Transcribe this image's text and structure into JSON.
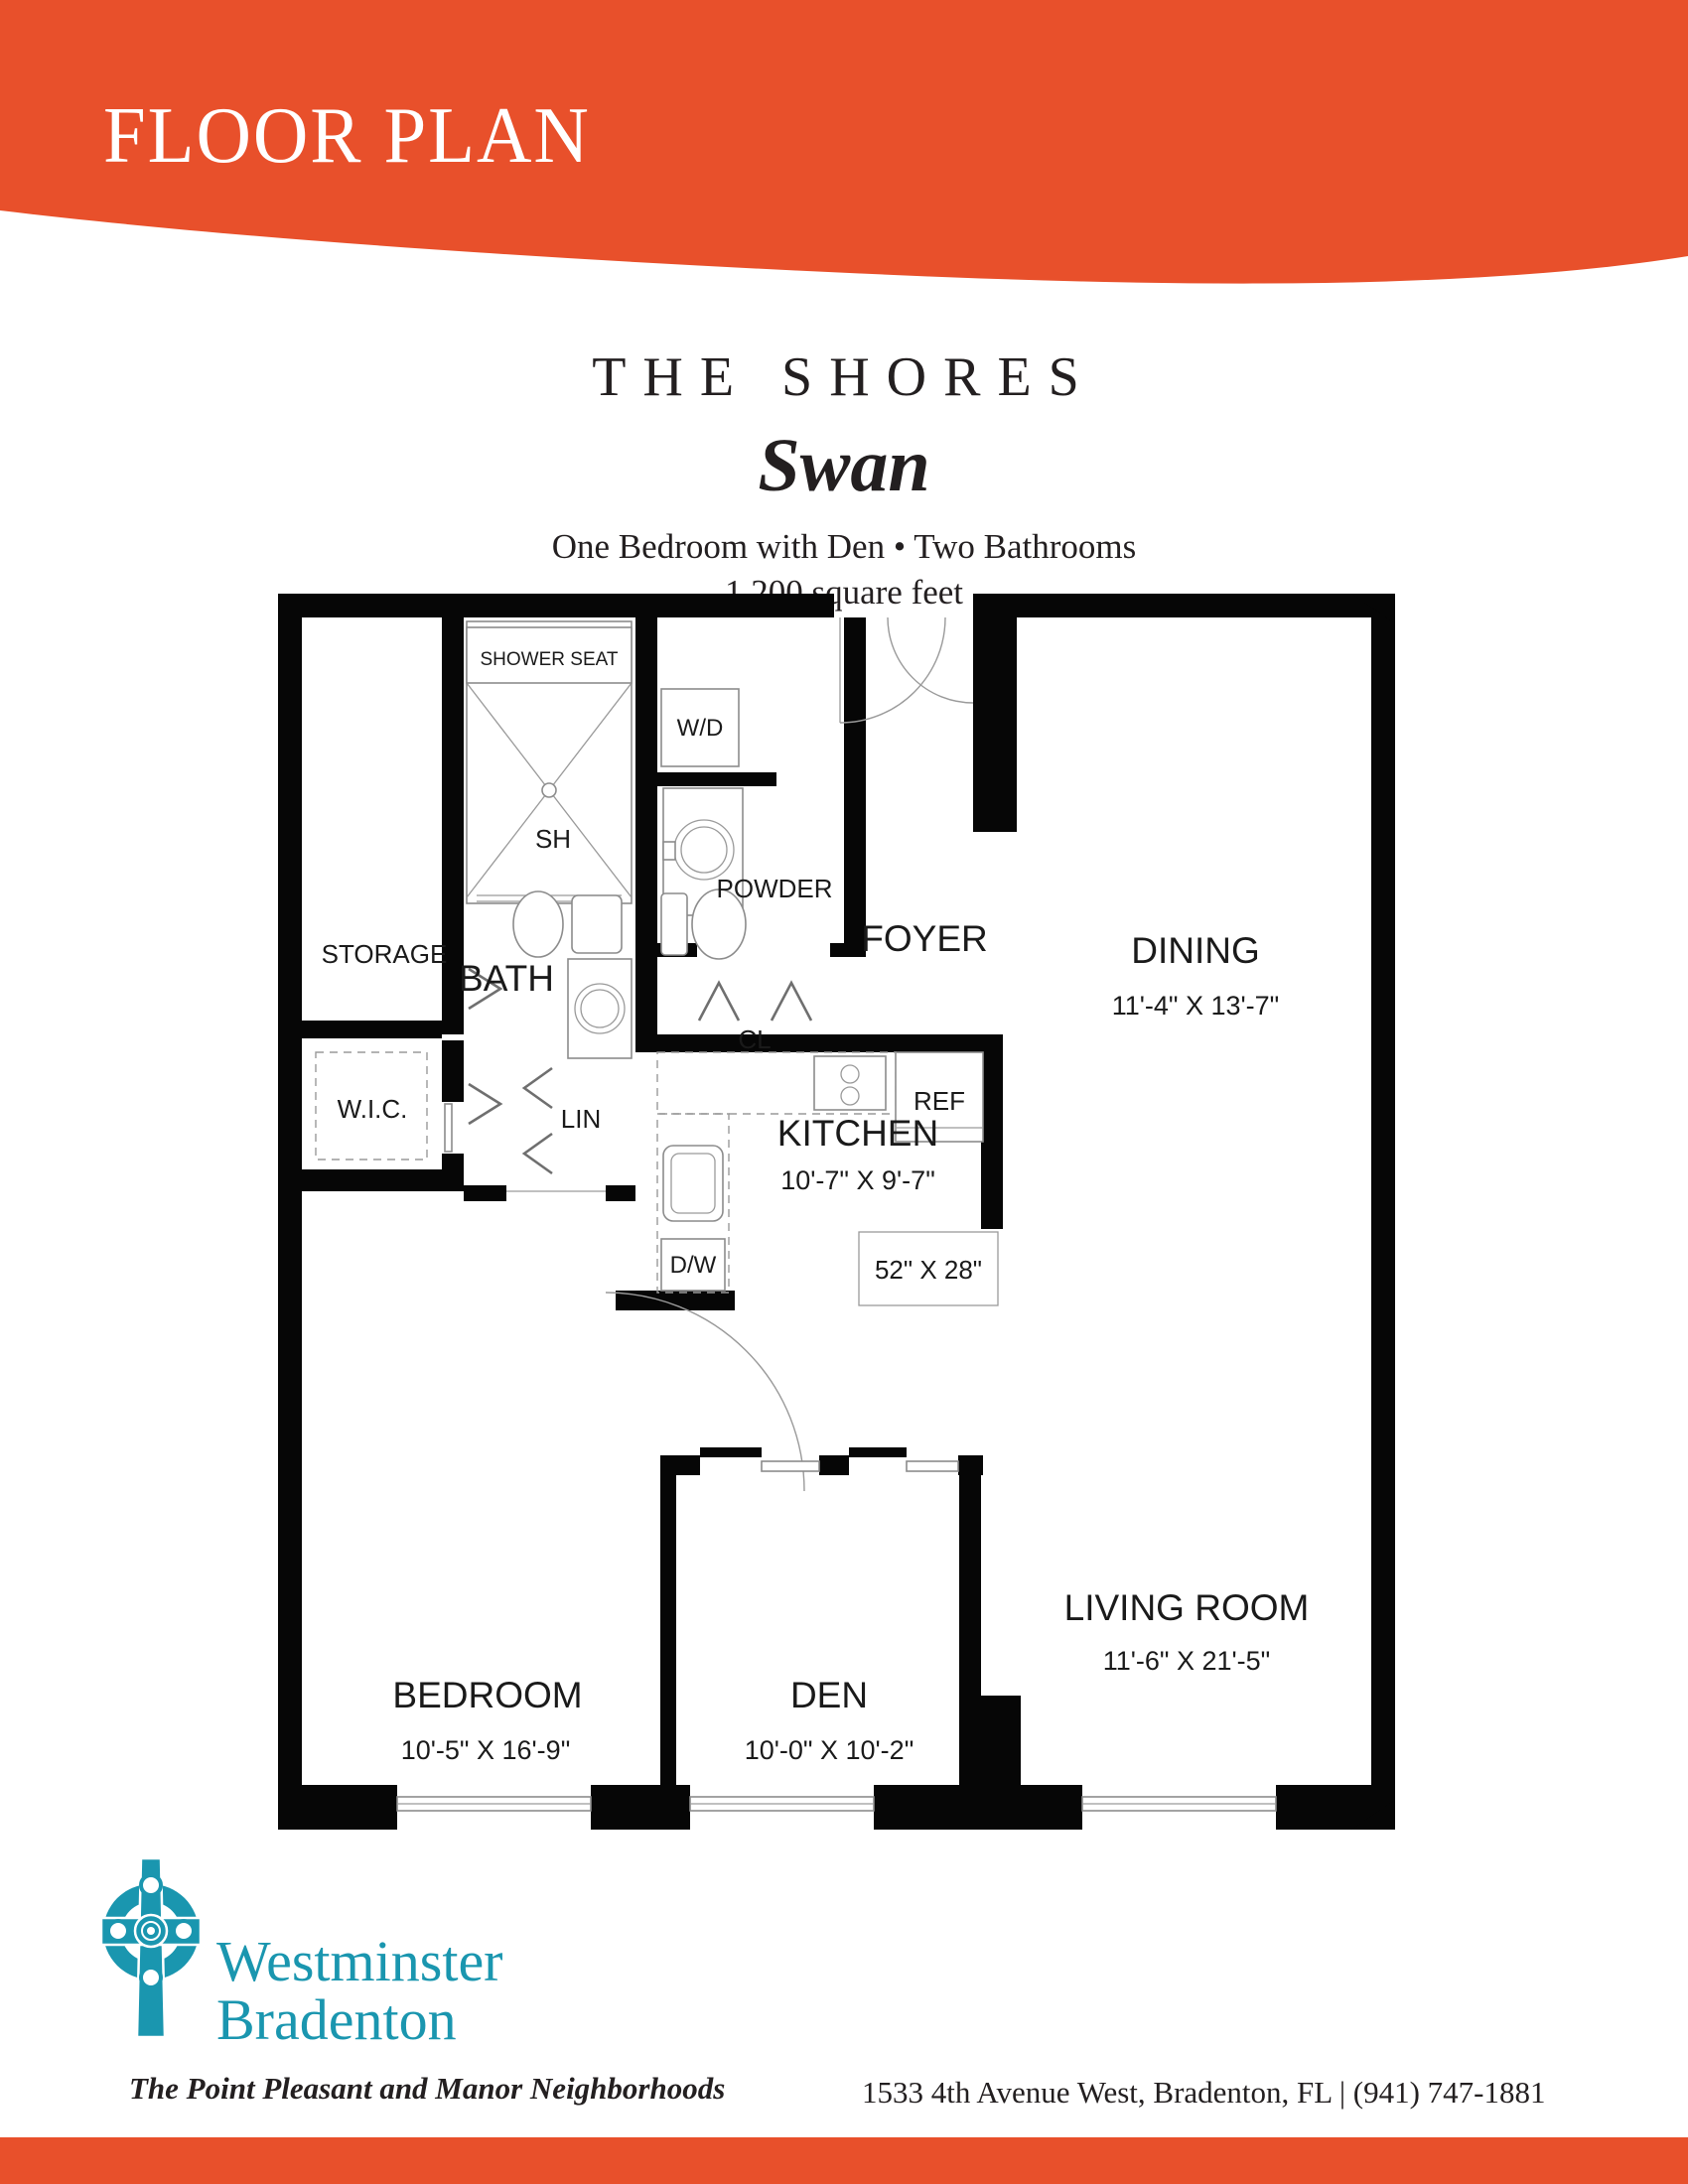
{
  "page": {
    "accent_orange": "#E8502B",
    "logo_teal": "#1A96AF",
    "ink": "#231F20"
  },
  "banner": {
    "title": "FLOOR PLAN"
  },
  "title_block": {
    "community": "THE SHORES",
    "model": "Swan",
    "features": "One Bedroom with Den • Two Bathrooms",
    "area": "1,200 square feet"
  },
  "plan": {
    "rooms": {
      "storage": {
        "label": "STORAGE"
      },
      "wic": {
        "label": "W.I.C."
      },
      "bath": {
        "label": "BATH"
      },
      "lin": {
        "label": "LIN"
      },
      "powder": {
        "label": "POWDER"
      },
      "cl": {
        "label": "CL"
      },
      "foyer": {
        "label": "FOYER"
      },
      "dining": {
        "label": "DINING",
        "dims": "11'-4\" X 13'-7\""
      },
      "kitchen": {
        "label": "KITCHEN",
        "dims": "10'-7\" X 9'-7\""
      },
      "bedroom": {
        "label": "BEDROOM",
        "dims": "10'-5\" X 16'-9\""
      },
      "den": {
        "label": "DEN",
        "dims": "10'-0\" X 10'-2\""
      },
      "living": {
        "label": "LIVING ROOM",
        "dims": "11'-6\" X 21'-5\""
      }
    },
    "fixtures": {
      "shower_seat": "SHOWER SEAT",
      "shower": "SH",
      "washer_dryer": "W/D",
      "refrigerator": "REF",
      "dishwasher": "D/W",
      "island": "52\" X 28\""
    }
  },
  "footer": {
    "org_line1": "Westminster",
    "org_line2": "Bradenton",
    "tagline": "The Point Pleasant and Manor Neighborhoods",
    "address": "1533 4th Avenue West, Bradenton, FL | (941) 747-1881"
  }
}
